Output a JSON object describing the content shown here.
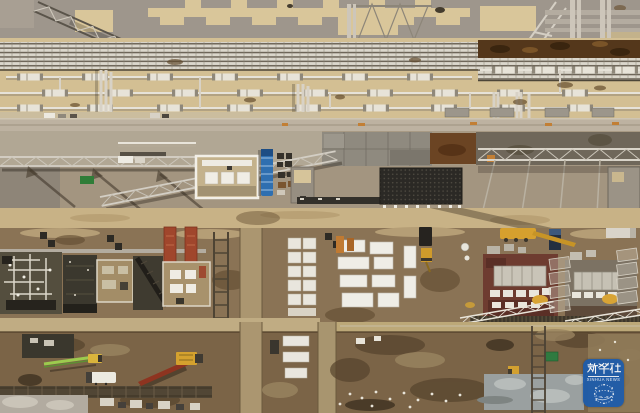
{
  "image": {
    "type": "aerial-drone-photograph",
    "description": "Top-down aerial view of a large petrochemical pipeline plant under construction: dense pipe racks, lattice crane booms, concrete work pads, excavated foundations, site containers and construction vehicles on tan and brown earth.",
    "width_px": 640,
    "height_px": 413
  },
  "watermark": {
    "title": "新华社",
    "subtitle": "XINHUA NEWS",
    "icon": "globe-network-icon",
    "background_color": "#1e5cab",
    "text_color": "#ffffff"
  },
  "palette": {
    "concrete_gray": "#9c948a",
    "sand_tan": "#d3bf93",
    "road_gray": "#bdb2a1",
    "earth_brown": "#8a7355",
    "deep_brown": "#6e5638",
    "pit_dark": "#39362c",
    "rust_trench": "#54371b",
    "maroon_foundation": "#6e3c30",
    "pipe_light": "#e2ded4",
    "steel_shadow": "#6b6257",
    "crane_yellow": "#d6a02e",
    "pump_green": "#9ccb4e",
    "truck_blue": "#2f6fb0",
    "formwork_red": "#a0462c",
    "slab_blue_gray": "#9aa0a0"
  },
  "scene": {
    "features": [
      "roof-deck-with-tan-panels",
      "tower-crane-lattice-booms",
      "horizontal-pipe-rack-bundles",
      "flanged-pipe-rows",
      "rust-colored-trench",
      "service-road-with-markings",
      "concrete-panel-pad",
      "blue-trailer-truck",
      "rebar-mesh-module",
      "white-bordered-work-pads",
      "red-formwork-towers",
      "dark-foundation-pits",
      "white-site-containers",
      "maroon-equipment-foundations",
      "mesh-scaffold-panels",
      "mobile-crane",
      "excavator",
      "concrete-pump-truck",
      "white-tanker-truck",
      "excavation-trenches",
      "blue-gray-concrete-slab",
      "green-container",
      "xinhua-news-watermark"
    ]
  }
}
